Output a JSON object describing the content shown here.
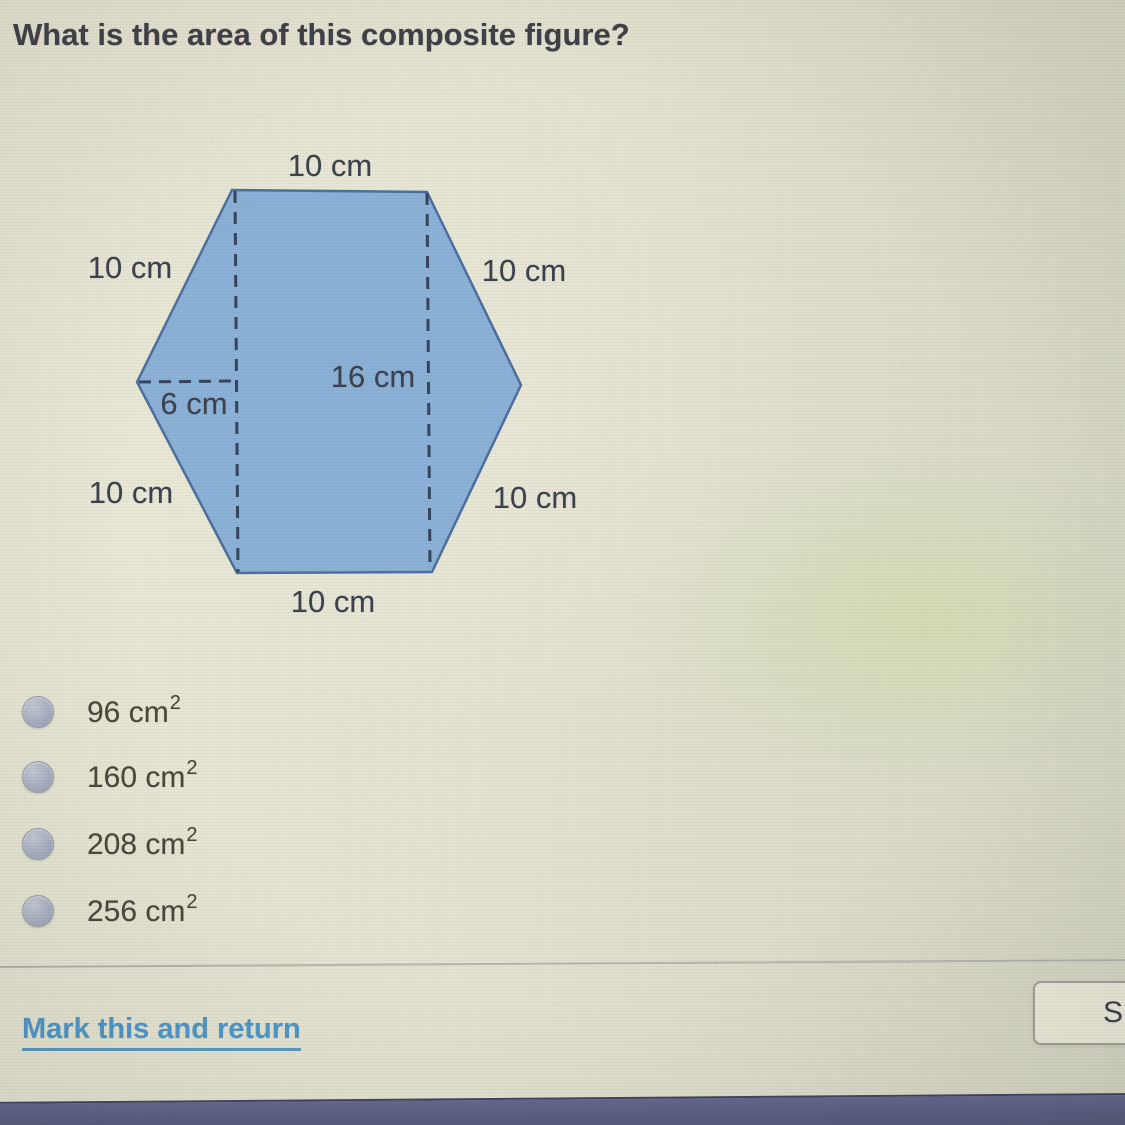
{
  "question": {
    "title": "What is the area of this composite figure?"
  },
  "diagram": {
    "shape": "hexagon",
    "fill_color": "#8ab1d8",
    "outline_color": "#4c6f9e",
    "dash_color": "#37425c",
    "labels": [
      {
        "id": "top-side",
        "text": "10 cm"
      },
      {
        "id": "upper-left-side",
        "text": "10 cm"
      },
      {
        "id": "upper-right-side",
        "text": "10 cm"
      },
      {
        "id": "center-height",
        "text": "16 cm"
      },
      {
        "id": "left-triangle-base",
        "text": "6 cm"
      },
      {
        "id": "lower-left-side",
        "text": "10 cm"
      },
      {
        "id": "lower-right-side",
        "text": "10 cm"
      },
      {
        "id": "bottom-side",
        "text": "10 cm"
      }
    ]
  },
  "choices": [
    {
      "base": "96 cm",
      "exp": "2",
      "selected": false
    },
    {
      "base": "160 cm",
      "exp": "2",
      "selected": false
    },
    {
      "base": "208 cm",
      "exp": "2",
      "selected": false
    },
    {
      "base": "256 cm",
      "exp": "2",
      "selected": false
    }
  ],
  "footer": {
    "mark_link": "Mark this and return",
    "save_button_label": "S"
  },
  "colors": {
    "background": "#e4e2d0",
    "hexagon_fill": "#8ab1d8",
    "link_blue": "#4e97cb",
    "bottom_bar": "#585c80",
    "answer_text": "#4a453c",
    "title_text": "#3e3e49"
  }
}
